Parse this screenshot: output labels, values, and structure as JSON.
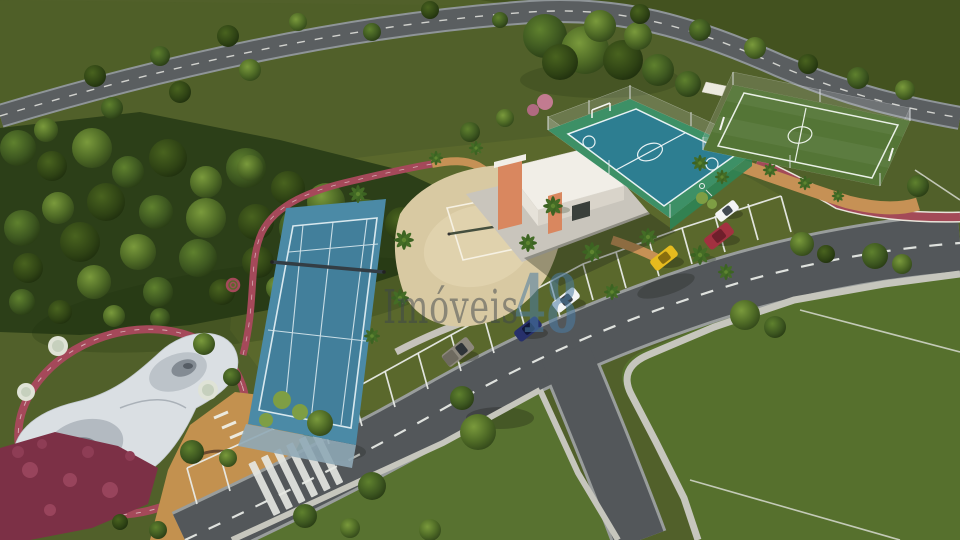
{
  "watermark": {
    "brand_text": "Imóveis",
    "brand_number": "48",
    "brand_text_color": "#3e454c",
    "brand_number_color": "#4b7ca3"
  },
  "scene": {
    "setting": "Aerial 3D architectural rendering of a condominium leisure area",
    "features": [
      {
        "id": "tennis-court",
        "label": "Tennis court",
        "color": "#4b8aa6"
      },
      {
        "id": "beach-volleyball-court",
        "label": "Beach volleyball court",
        "color": "#d8c9a2"
      },
      {
        "id": "multisport-court",
        "label": "Multi-sport court",
        "color": "#3d9066",
        "inner_color": "#2d7e91"
      },
      {
        "id": "soccer-field",
        "label": "Soccer field",
        "color": "#547536"
      },
      {
        "id": "skate-park",
        "label": "Skate park",
        "color": "#dadfe3"
      },
      {
        "id": "jogging-track",
        "label": "Jogging track",
        "color": "#a5495a"
      },
      {
        "id": "clubhouse",
        "label": "Support building",
        "color": "#f1eee7",
        "accent_color": "#d9875f"
      },
      {
        "id": "plaza",
        "label": "Gravel plaza",
        "color": "#c3914f"
      },
      {
        "id": "roads",
        "label": "Asphalt roads",
        "color": "#53575a"
      },
      {
        "id": "forest",
        "label": "Forest belt",
        "color": "#2c3f18"
      },
      {
        "id": "lawn",
        "label": "Lawn lots",
        "color": "#56702d"
      }
    ],
    "vehicles": [
      {
        "id": "car-red",
        "color": "#a23140"
      },
      {
        "id": "car-yellow",
        "color": "#e5bb1e"
      },
      {
        "id": "car-white",
        "color": "#f3f4f5"
      },
      {
        "id": "car-navy",
        "color": "#27306b"
      },
      {
        "id": "truck-gray",
        "color": "#8d887c"
      },
      {
        "id": "car-white-2",
        "color": "#f3f4f5"
      }
    ]
  }
}
